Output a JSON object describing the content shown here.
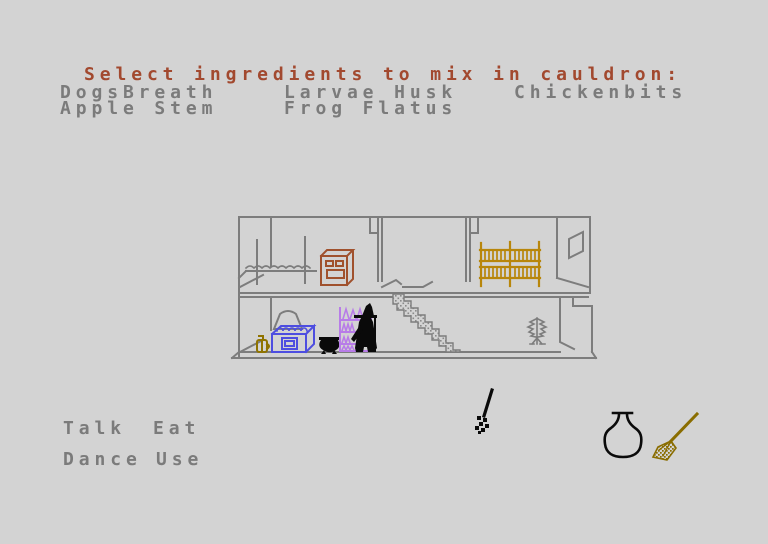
{
  "prompt": {
    "title": "Select ingredients to mix in cauldron:"
  },
  "ingredients": {
    "items": [
      {
        "label": "DogsBreath"
      },
      {
        "label": "Larvae Husk"
      },
      {
        "label": "Chickenbits"
      },
      {
        "label": "Apple Stem"
      },
      {
        "label": "Frog Flatus"
      }
    ]
  },
  "verbs": {
    "items": [
      {
        "label": "Talk"
      },
      {
        "label": "Eat"
      },
      {
        "label": "Dance"
      },
      {
        "label": "Use"
      }
    ]
  },
  "inventory": {
    "items": [
      {
        "icon": "flask-icon"
      },
      {
        "icon": "broom-icon"
      }
    ]
  },
  "scene": {
    "objects": [
      "house",
      "bed",
      "stove",
      "bunk-bed",
      "window",
      "stairs",
      "hanging-lamp",
      "blue-cooker",
      "gold-jar",
      "cauldron",
      "potion-shelf",
      "witch",
      "plant",
      "dropped-broom"
    ]
  },
  "colors": {
    "background": "#d3d3d3",
    "text_gray": "#7b7b7b",
    "title_red": "#a2492f",
    "wall_gray": "#7d7d7d",
    "stove_red": "#a0512d",
    "bunk_gold": "#b8860b",
    "shelf_purple": "#b87ce8",
    "cooker_blue": "#4d4de0",
    "jar_gold": "#8f7300",
    "broom_gold": "#8a6d00",
    "sprite_black": "#0a0a0a"
  }
}
